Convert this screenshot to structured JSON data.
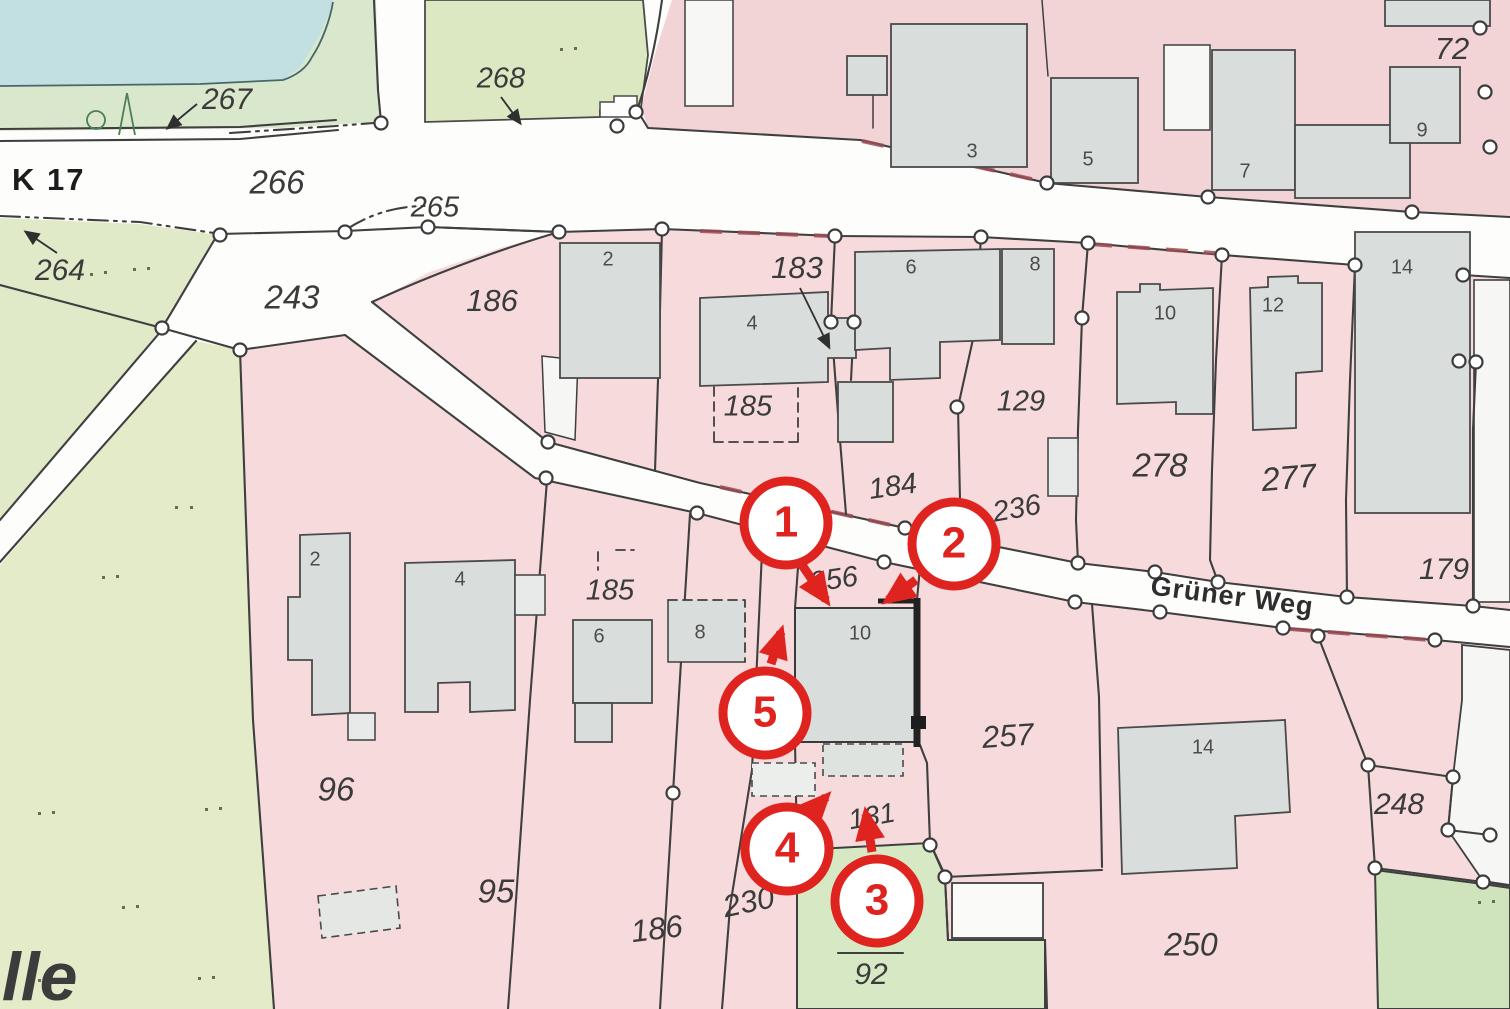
{
  "labels": {
    "k17": "K 17",
    "street": "Grüner Weg",
    "edge_text": "elle"
  },
  "parcels": {
    "p264": "264",
    "p265": "265",
    "p266": "266",
    "p267": "267",
    "p268": "268",
    "p243": "243",
    "p186n": "186",
    "p183": "183",
    "p185n": "185",
    "p129": "129",
    "p184": "184",
    "p236": "236",
    "p278": "278",
    "p277": "277",
    "p179": "179",
    "p256": "256",
    "p72": "72",
    "p257": "257",
    "p131": "131",
    "p96": "96",
    "p95": "95",
    "p186s": "186",
    "p230": "230",
    "p92": "92",
    "p250": "250",
    "p248": "248",
    "p185s": "185"
  },
  "houses_north": {
    "h3": "3",
    "h5": "5",
    "h7": "7",
    "h9": "9",
    "h2": "2",
    "h4": "4",
    "h6": "6",
    "h8": "8",
    "h10": "10",
    "h12": "12",
    "h14": "14"
  },
  "houses_south": {
    "s2": "2",
    "s4": "4",
    "s6": "6",
    "s8": "8",
    "s10": "10",
    "s14": "14"
  },
  "markers": {
    "m1": "1",
    "m2": "2",
    "m3": "3",
    "m4": "4",
    "m5": "5"
  },
  "colors": {
    "water": "#c2dfe1",
    "green_olive": "#e0e9c8",
    "green_bright": "#cfe4bd",
    "pink_parcel": "#f7dbdc",
    "building_gray": "#d9dedd",
    "line_dark": "#3f3f3f",
    "marker_red": "#df241f",
    "road_edge_maroon": "#9a4b52"
  }
}
